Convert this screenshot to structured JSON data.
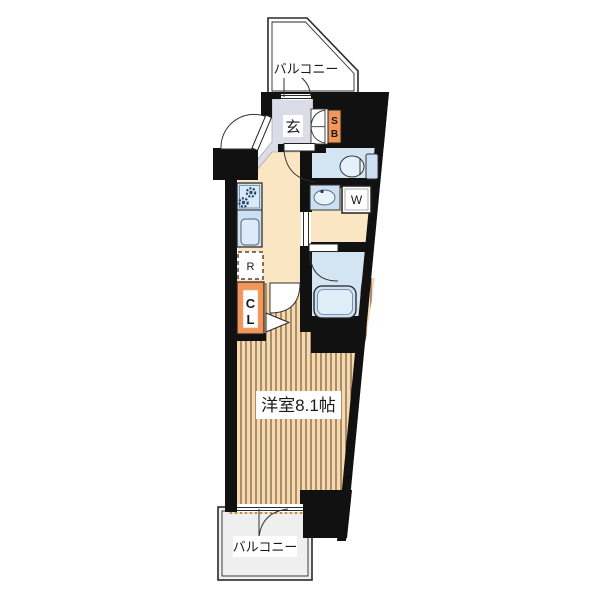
{
  "floorplan": {
    "labels": {
      "balcony_top": "バルコニー",
      "balcony_bottom": "バルコニー",
      "entrance": "玄",
      "main_room": "洋室8.1帖",
      "shoe_box_s": "S",
      "shoe_box_b": "B",
      "closet_c": "C",
      "closet_l": "L",
      "washer": "W",
      "fridge": "R"
    },
    "colors": {
      "wall": "#111111",
      "wood_floor": "#F6D9AF",
      "wood_grain": "#6b5136",
      "hall_floor": "#FAE6C3",
      "entry_floor": "#DCDCE8",
      "wet_room_floor": "#D3E4F2",
      "fixture_blue": "#CBE0F2",
      "cabinet_orange": "#F2965A",
      "balcony_gray": "#EFEFEF"
    }
  }
}
